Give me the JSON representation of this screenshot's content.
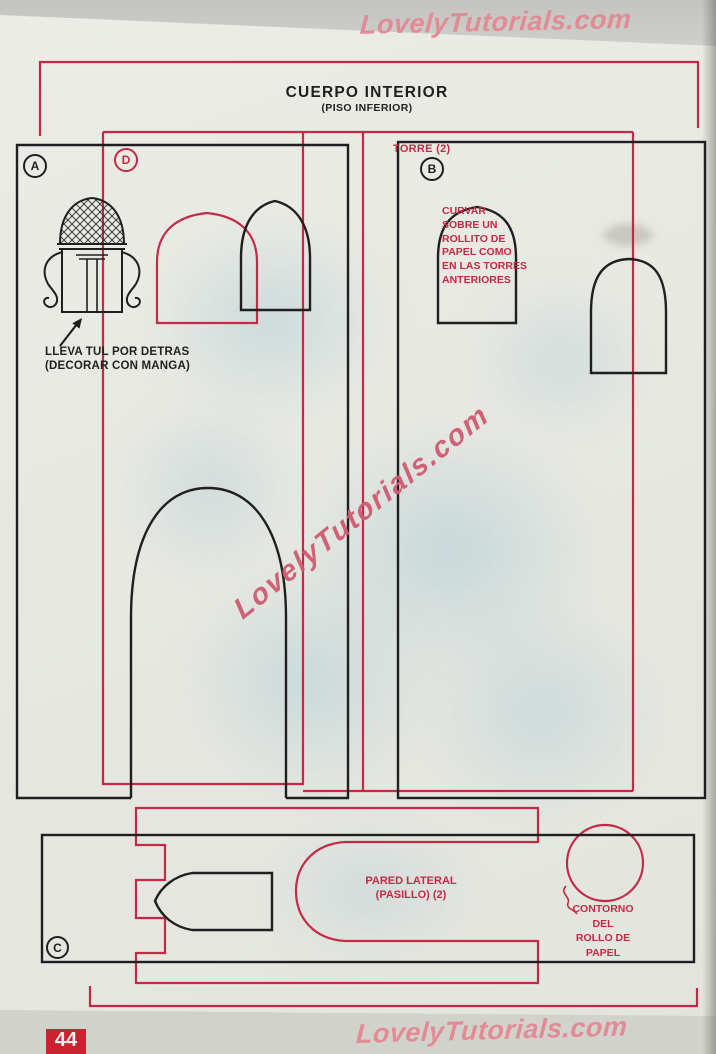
{
  "page": {
    "title": "CUERPO INTERIOR",
    "subtitle": "(PISO INFERIOR)",
    "page_number": "44",
    "watermark": "LovelyTutorials.com"
  },
  "pieces": {
    "a": {
      "label": "A",
      "annotation_line1": "LLEVA TUL POR DETRAS",
      "annotation_line2": "(DECORAR CON MANGA)"
    },
    "b": {
      "label": "B",
      "name": "TORRE (2)",
      "note_lines": [
        "CURVAR",
        "SOBRE UN",
        "ROLLITO DE",
        "PAPEL COMO",
        "EN LAS TORRES",
        "ANTERIORES"
      ]
    },
    "c": {
      "label": "C",
      "name_line1": "PARED LATERAL",
      "name_line2": "(PASILLO) (2)",
      "contour_lines": [
        "CONTORNO",
        "DEL",
        "ROLLO DE",
        "PAPEL"
      ]
    },
    "d": {
      "label": "D"
    }
  },
  "colors": {
    "pattern_red": "#c42a44",
    "ink_black": "#1f1f1f",
    "watermark_pink": "#e28b94",
    "watermark_center_pink": "#d15a70",
    "paper": "#e8e9e3",
    "badge_red": "#c8232f"
  }
}
